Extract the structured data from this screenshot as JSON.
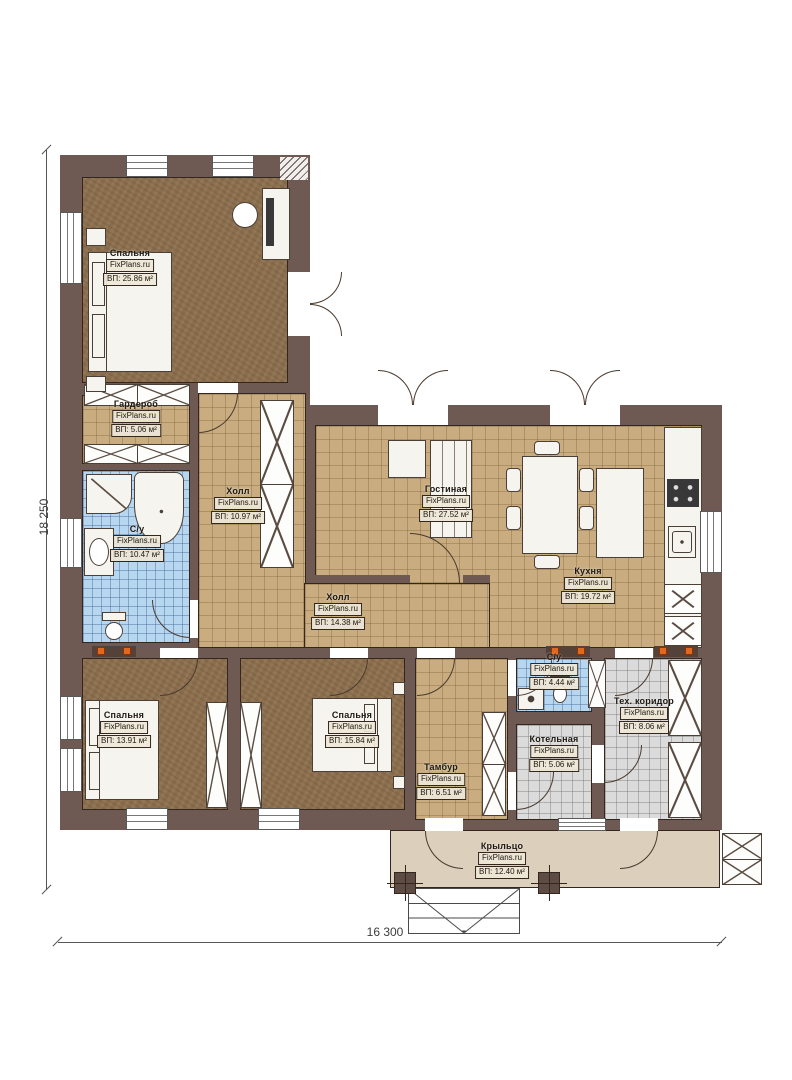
{
  "drawing": {
    "type": "house-floor-plan",
    "brand": "FixPlans.ru"
  },
  "dimensions": {
    "left": "18 250",
    "bottom": "16 300"
  },
  "rooms": [
    {
      "id": "bedroom-top-left",
      "name": "Спальня",
      "brand": "FixPlans.ru",
      "area": "ВП: 25.86 м²"
    },
    {
      "id": "wardrobe",
      "name": "Гардероб",
      "brand": "FixPlans.ru",
      "area": "ВП: 5.06 м²"
    },
    {
      "id": "bathroom-main",
      "name": "С/у",
      "brand": "FixPlans.ru",
      "area": "ВП: 10.47 м²"
    },
    {
      "id": "hall-top",
      "name": "Холл",
      "brand": "FixPlans.ru",
      "area": "ВП: 10.97 м²"
    },
    {
      "id": "living-room",
      "name": "Гостиная",
      "brand": "FixPlans.ru",
      "area": "ВП: 27.52 м²"
    },
    {
      "id": "kitchen",
      "name": "Кухня",
      "brand": "FixPlans.ru",
      "area": "ВП: 19.72 м²"
    },
    {
      "id": "hall-middle",
      "name": "Холл",
      "brand": "FixPlans.ru",
      "area": "ВП: 14.38 м²"
    },
    {
      "id": "bedroom-bottom-left",
      "name": "Спальня",
      "brand": "FixPlans.ru",
      "area": "ВП: 13.91 м²"
    },
    {
      "id": "bedroom-bottom-middle",
      "name": "Спальня",
      "brand": "FixPlans.ru",
      "area": "ВП: 15.84 м²"
    },
    {
      "id": "vestibule",
      "name": "Тамбур",
      "brand": "FixPlans.ru",
      "area": "ВП: 6.51 м²"
    },
    {
      "id": "bathroom-small",
      "name": "С/у",
      "brand": "FixPlans.ru",
      "area": "ВП: 4.44 м²"
    },
    {
      "id": "boiler-room",
      "name": "Котельная",
      "brand": "FixPlans.ru",
      "area": "ВП: 5.06 м²"
    },
    {
      "id": "tech-corridor",
      "name": "Тех. коридор",
      "brand": "FixPlans.ru",
      "area": "ВП: 8.06 м²"
    },
    {
      "id": "porch",
      "name": "Крыльцо",
      "brand": "FixPlans.ru",
      "area": "ВП: 12.40 м²"
    }
  ],
  "colors": {
    "wall": "#6f5a53",
    "floor_wood": "#8a6e4d",
    "floor_tile_tan": "#c9ad80",
    "floor_tile_blue": "#b7d6f0",
    "floor_tile_gray": "#dbdbdb",
    "porch": "#dccfbc",
    "radiator_accent": "#e2681f"
  }
}
